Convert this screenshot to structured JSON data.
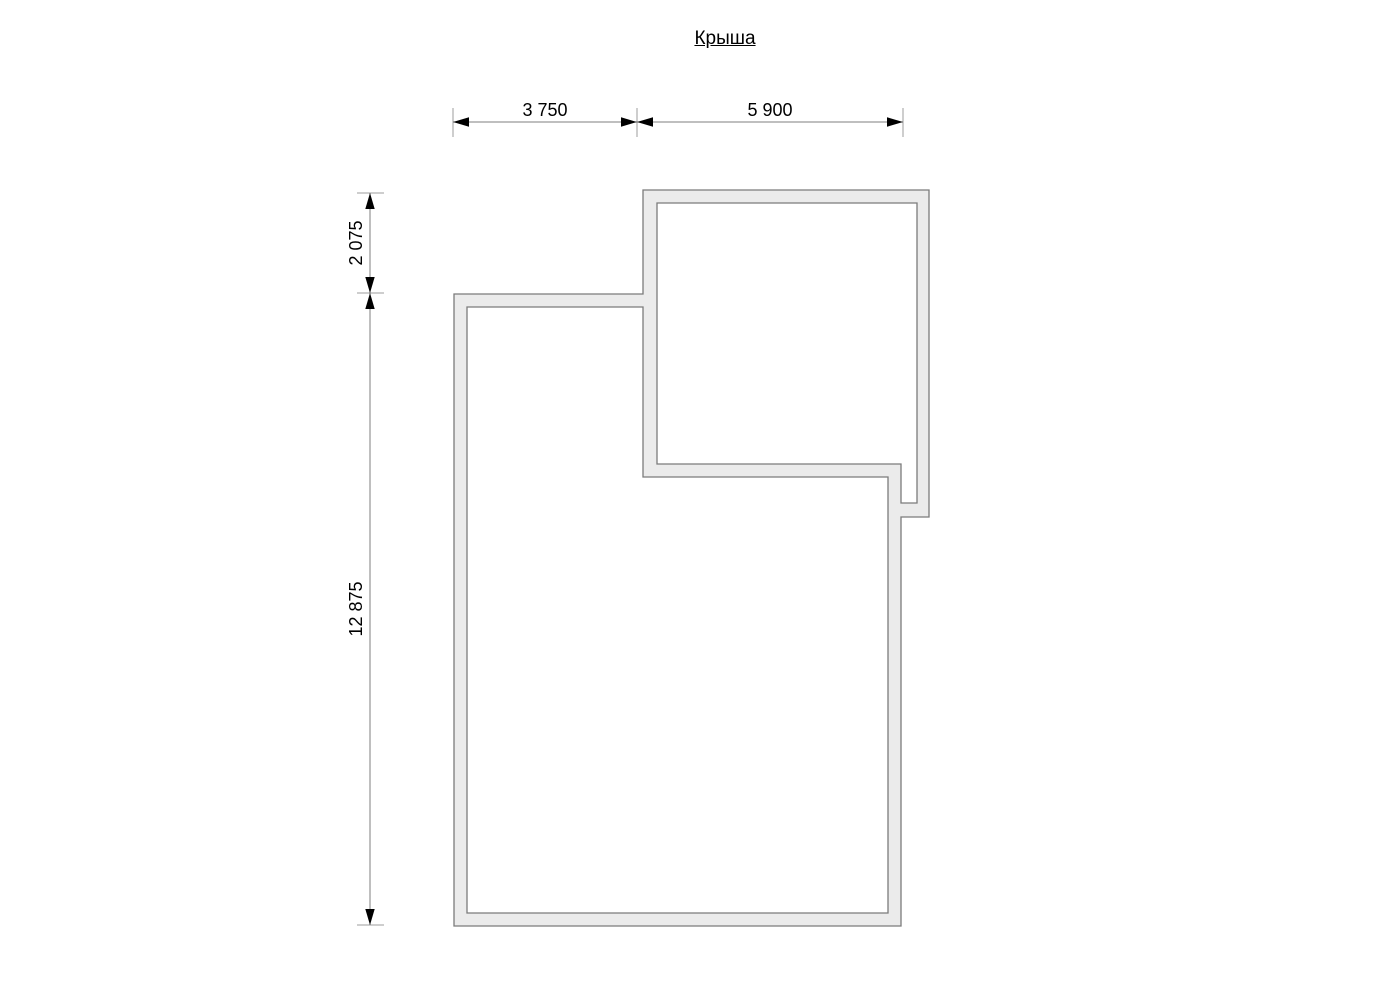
{
  "title": {
    "text": "Крыша"
  },
  "drawing": {
    "kind": "roof-plan",
    "wall_fill": "#ebebeb",
    "wall_stroke": "#7b7b7b",
    "dim_line_color": "#7f7f7f",
    "dim_tick_color": "#9c9c9c",
    "dim_arrow_color": "#000000"
  },
  "dimensions": {
    "horizontal": {
      "segments": [
        {
          "label": "3 750"
        },
        {
          "label": "5 900"
        }
      ]
    },
    "vertical": {
      "segments": [
        {
          "label": "2 075"
        },
        {
          "label": "12 875"
        }
      ]
    }
  }
}
